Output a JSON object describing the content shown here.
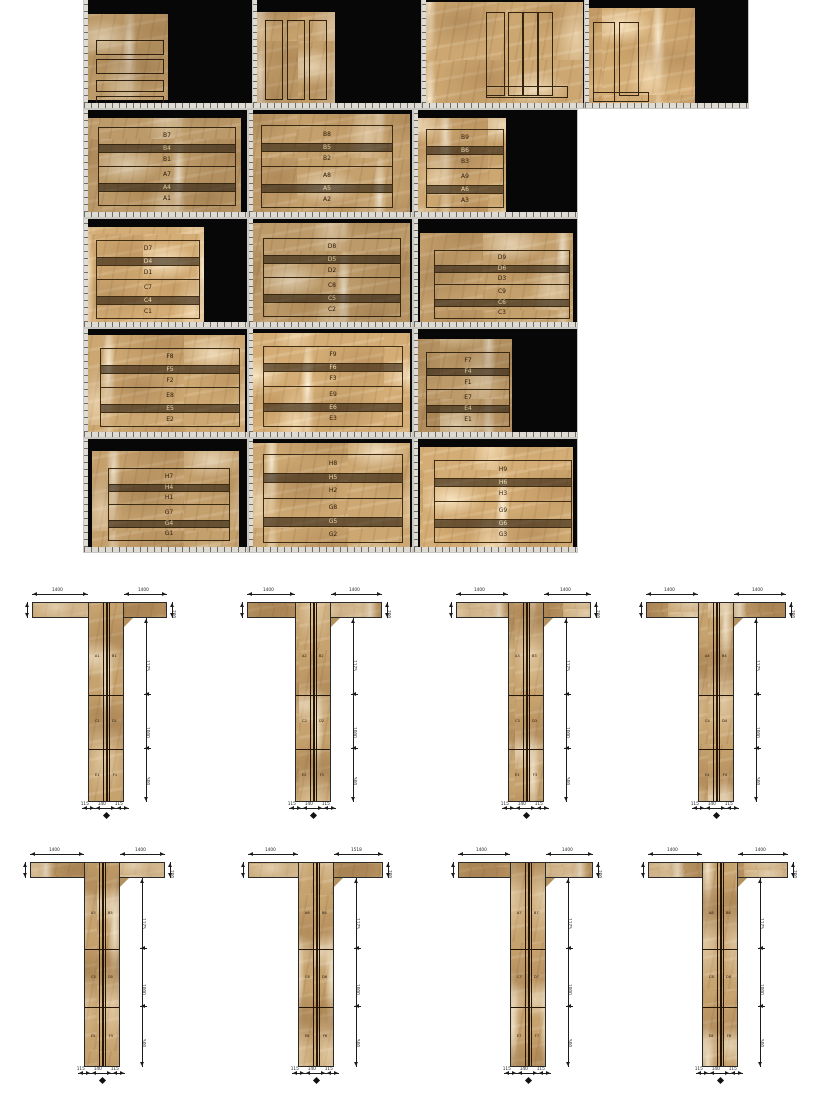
{
  "document": {
    "title": "stone-slab-cutting-layout",
    "background": "#ffffff",
    "sheet_background": "#070707",
    "marble_base_color": "#c6a26e",
    "outline_color": "#3c2a12"
  },
  "slab_sheets": [
    {
      "id": "r1s1",
      "x": 84,
      "y": 0,
      "w": 169,
      "h": 108,
      "marble": {
        "x": 4,
        "y": 14,
        "w": 80,
        "h": 86
      },
      "strips": [
        [
          8,
          26,
          66,
          13
        ],
        [
          8,
          45,
          66,
          13
        ],
        [
          8,
          66,
          66,
          10
        ],
        [
          8,
          82,
          66,
          8
        ]
      ],
      "labels": []
    },
    {
      "id": "r1s2",
      "x": 253,
      "y": 0,
      "w": 169,
      "h": 108,
      "marble": {
        "x": 4,
        "y": 12,
        "w": 78,
        "h": 92
      },
      "strips": [
        [
          8,
          8,
          16,
          78
        ],
        [
          30,
          8,
          16,
          78
        ],
        [
          52,
          8,
          16,
          78
        ]
      ],
      "labels": []
    },
    {
      "id": "r1s3",
      "x": 422,
      "y": 0,
      "w": 163,
      "h": 108,
      "marble": {
        "x": 2,
        "y": 2,
        "w": 159,
        "h": 102
      },
      "strips": [
        [
          62,
          10,
          17,
          82
        ],
        [
          84,
          10,
          13,
          82
        ],
        [
          99,
          10,
          13,
          82
        ],
        [
          114,
          10,
          13,
          82
        ],
        [
          62,
          84,
          80,
          10
        ]
      ],
      "labels": []
    },
    {
      "id": "r1s4",
      "x": 585,
      "y": 0,
      "w": 163,
      "h": 108,
      "marble": {
        "x": 2,
        "y": 8,
        "w": 108,
        "h": 96
      },
      "strips": [
        [
          6,
          14,
          20,
          78
        ],
        [
          32,
          14,
          18,
          72
        ],
        [
          6,
          84,
          54,
          8
        ]
      ],
      "labels": []
    },
    {
      "id": "r2s1",
      "x": 84,
      "y": 110,
      "w": 163,
      "h": 107,
      "marble": {
        "x": 4,
        "y": 8,
        "w": 153,
        "h": 95
      },
      "bands": {
        "x": 10,
        "y": 10,
        "w": 138
      },
      "labels": [
        "B7",
        "B4",
        "B1",
        "A7",
        "A4",
        "A1"
      ]
    },
    {
      "id": "r2s2",
      "x": 249,
      "y": 110,
      "w": 163,
      "h": 107,
      "marble": {
        "x": 2,
        "y": 4,
        "w": 159,
        "h": 101
      },
      "bands": {
        "x": 10,
        "y": 12,
        "w": 132
      },
      "labels": [
        "B8",
        "B5",
        "B2",
        "A8",
        "A5",
        "A2"
      ]
    },
    {
      "id": "r2s3",
      "x": 414,
      "y": 110,
      "w": 163,
      "h": 107,
      "marble": {
        "x": 4,
        "y": 8,
        "w": 88,
        "h": 97
      },
      "bands": {
        "x": 8,
        "y": 12,
        "w": 78
      },
      "labels": [
        "B9",
        "B6",
        "B3",
        "A9",
        "A6",
        "A3"
      ]
    },
    {
      "id": "r3s1",
      "x": 84,
      "y": 219,
      "w": 163,
      "h": 108,
      "marble": {
        "x": 4,
        "y": 8,
        "w": 116,
        "h": 98
      },
      "bands": {
        "x": 8,
        "y": 14,
        "w": 104
      },
      "labels": [
        "D7",
        "D4",
        "D1",
        "C7",
        "C4",
        "C1"
      ]
    },
    {
      "id": "r3s2",
      "x": 249,
      "y": 219,
      "w": 163,
      "h": 108,
      "marble": {
        "x": 2,
        "y": 4,
        "w": 159,
        "h": 102
      },
      "bands": {
        "x": 12,
        "y": 16,
        "w": 138
      },
      "labels": [
        "D8",
        "D5",
        "D2",
        "C8",
        "C5",
        "C2"
      ]
    },
    {
      "id": "r3s3",
      "x": 414,
      "y": 219,
      "w": 163,
      "h": 108,
      "marble": {
        "x": 6,
        "y": 14,
        "w": 153,
        "h": 92
      },
      "bands": {
        "x": 14,
        "y": 18,
        "w": 136
      },
      "labels": [
        "D9",
        "D6",
        "D3",
        "C9",
        "C6",
        "C3"
      ]
    },
    {
      "id": "r4s1",
      "x": 84,
      "y": 329,
      "w": 163,
      "h": 108,
      "marble": {
        "x": 4,
        "y": 6,
        "w": 157,
        "h": 100
      },
      "bands": {
        "x": 12,
        "y": 14,
        "w": 140
      },
      "labels": [
        "F8",
        "F5",
        "F2",
        "E8",
        "E5",
        "E2"
      ]
    },
    {
      "id": "r4s2",
      "x": 249,
      "y": 329,
      "w": 163,
      "h": 108,
      "marble": {
        "x": 2,
        "y": 4,
        "w": 159,
        "h": 102
      },
      "bands": {
        "x": 12,
        "y": 14,
        "w": 140
      },
      "labels": [
        "F9",
        "F6",
        "F3",
        "E9",
        "E6",
        "E3"
      ]
    },
    {
      "id": "r4s3",
      "x": 414,
      "y": 329,
      "w": 163,
      "h": 108,
      "marble": {
        "x": 4,
        "y": 10,
        "w": 94,
        "h": 96
      },
      "bands": {
        "x": 8,
        "y": 14,
        "w": 84
      },
      "labels": [
        "F7",
        "F4",
        "F1",
        "E7",
        "E4",
        "E1"
      ]
    },
    {
      "id": "r5s1",
      "x": 84,
      "y": 439,
      "w": 163,
      "h": 113,
      "marble": {
        "x": 8,
        "y": 12,
        "w": 147,
        "h": 99
      },
      "bands": {
        "x": 16,
        "y": 18,
        "w": 122
      },
      "labels": [
        "H7",
        "H4",
        "H1",
        "G7",
        "G4",
        "G1"
      ]
    },
    {
      "id": "r5s2",
      "x": 249,
      "y": 439,
      "w": 163,
      "h": 113,
      "marble": {
        "x": 2,
        "y": 4,
        "w": 159,
        "h": 107
      },
      "bands": {
        "x": 12,
        "y": 12,
        "w": 140
      },
      "labels": [
        "H8",
        "H5",
        "H2",
        "G8",
        "G5",
        "G2"
      ]
    },
    {
      "id": "r5s3",
      "x": 414,
      "y": 439,
      "w": 163,
      "h": 113,
      "marble": {
        "x": 6,
        "y": 8,
        "w": 153,
        "h": 103
      },
      "bands": {
        "x": 14,
        "y": 14,
        "w": 138
      },
      "labels": [
        "H9",
        "H6",
        "H3",
        "G9",
        "G6",
        "G3"
      ]
    }
  ],
  "band_height_pattern": [
    0.2,
    0.085,
    0.165,
    0.2,
    0.085,
    0.165
  ],
  "t_columns": [
    {
      "id": "tA1",
      "x": 32,
      "y": 588,
      "flange_w": 135,
      "flange_h": 16,
      "stem_cx": 74,
      "stem_w": 36,
      "stem_h": 200,
      "cuts": [
        0.46,
        0.73
      ],
      "segments": [
        "A1 B1",
        "C1 D1",
        "E1 F1"
      ],
      "dims": {
        "top_left": "1400",
        "top_right": "1400",
        "flange_side": "200",
        "right": [
          "1175",
          "1000",
          "500"
        ],
        "bottom": [
          "115",
          "140",
          "115"
        ]
      }
    },
    {
      "id": "tA2",
      "x": 247,
      "y": 588,
      "flange_w": 135,
      "flange_h": 16,
      "stem_cx": 66,
      "stem_w": 36,
      "stem_h": 200,
      "cuts": [
        0.46,
        0.73
      ],
      "segments": [
        "A2 B2",
        "C2 D2",
        "E2 F2"
      ],
      "dims": {
        "top_left": "1400",
        "top_right": "1400",
        "flange_side": "200",
        "right": [
          "1175",
          "1000",
          "500"
        ],
        "bottom": [
          "115",
          "140",
          "115"
        ]
      }
    },
    {
      "id": "tA3",
      "x": 456,
      "y": 588,
      "flange_w": 135,
      "flange_h": 16,
      "stem_cx": 70,
      "stem_w": 36,
      "stem_h": 200,
      "cuts": [
        0.46,
        0.73
      ],
      "segments": [
        "A3 B3",
        "C3 D3",
        "E3 F3"
      ],
      "dims": {
        "top_left": "1400",
        "top_right": "1400",
        "flange_side": "200",
        "right": [
          "1175",
          "1000",
          "500"
        ],
        "bottom": [
          "115",
          "140",
          "115"
        ]
      }
    },
    {
      "id": "tA4",
      "x": 646,
      "y": 588,
      "flange_w": 140,
      "flange_h": 16,
      "stem_cx": 70,
      "stem_w": 36,
      "stem_h": 200,
      "cuts": [
        0.46,
        0.73
      ],
      "segments": [
        "A4 B4",
        "C4 D4",
        "E4 F4"
      ],
      "dims": {
        "top_left": "1400",
        "top_right": "1400",
        "flange_side": "200",
        "right": [
          "1175",
          "1000",
          "500"
        ],
        "bottom": [
          "115",
          "140",
          "115"
        ]
      }
    },
    {
      "id": "tB1",
      "x": 30,
      "y": 848,
      "flange_w": 135,
      "flange_h": 16,
      "stem_cx": 72,
      "stem_w": 36,
      "stem_h": 205,
      "cuts": [
        0.42,
        0.7
      ],
      "segments": [
        "A5 B5",
        "C5 D5",
        "E5 F5"
      ],
      "dims": {
        "top_left": "1400",
        "top_right": "1400",
        "flange_side": "200",
        "right": [
          "1175",
          "1000",
          "500"
        ],
        "bottom": [
          "115",
          "140",
          "115"
        ]
      }
    },
    {
      "id": "tB2",
      "x": 248,
      "y": 848,
      "flange_w": 135,
      "flange_h": 16,
      "stem_cx": 68,
      "stem_w": 36,
      "stem_h": 205,
      "cuts": [
        0.42,
        0.7
      ],
      "segments": [
        "A6 B6",
        "C6 D6",
        "E6 F6"
      ],
      "dims": {
        "top_left": "1400",
        "top_right": "1518",
        "flange_side": "200",
        "right": [
          "1175",
          "1000",
          "500"
        ],
        "bottom": [
          "115",
          "140",
          "115"
        ]
      }
    },
    {
      "id": "tB3",
      "x": 458,
      "y": 848,
      "flange_w": 135,
      "flange_h": 16,
      "stem_cx": 70,
      "stem_w": 36,
      "stem_h": 205,
      "cuts": [
        0.42,
        0.7
      ],
      "segments": [
        "A7 B7",
        "C7 D7",
        "E7 F7"
      ],
      "dims": {
        "top_left": "1400",
        "top_right": "1400",
        "flange_side": "200",
        "right": [
          "1175",
          "1000",
          "500"
        ],
        "bottom": [
          "115",
          "140",
          "115"
        ]
      }
    },
    {
      "id": "tB4",
      "x": 648,
      "y": 848,
      "flange_w": 140,
      "flange_h": 16,
      "stem_cx": 72,
      "stem_w": 36,
      "stem_h": 205,
      "cuts": [
        0.42,
        0.7
      ],
      "segments": [
        "A8 B8",
        "C8 D8",
        "E8 F8"
      ],
      "dims": {
        "top_left": "1400",
        "top_right": "1400",
        "flange_side": "200",
        "right": [
          "1175",
          "1000",
          "500"
        ],
        "bottom": [
          "115",
          "140",
          "115"
        ]
      }
    }
  ]
}
